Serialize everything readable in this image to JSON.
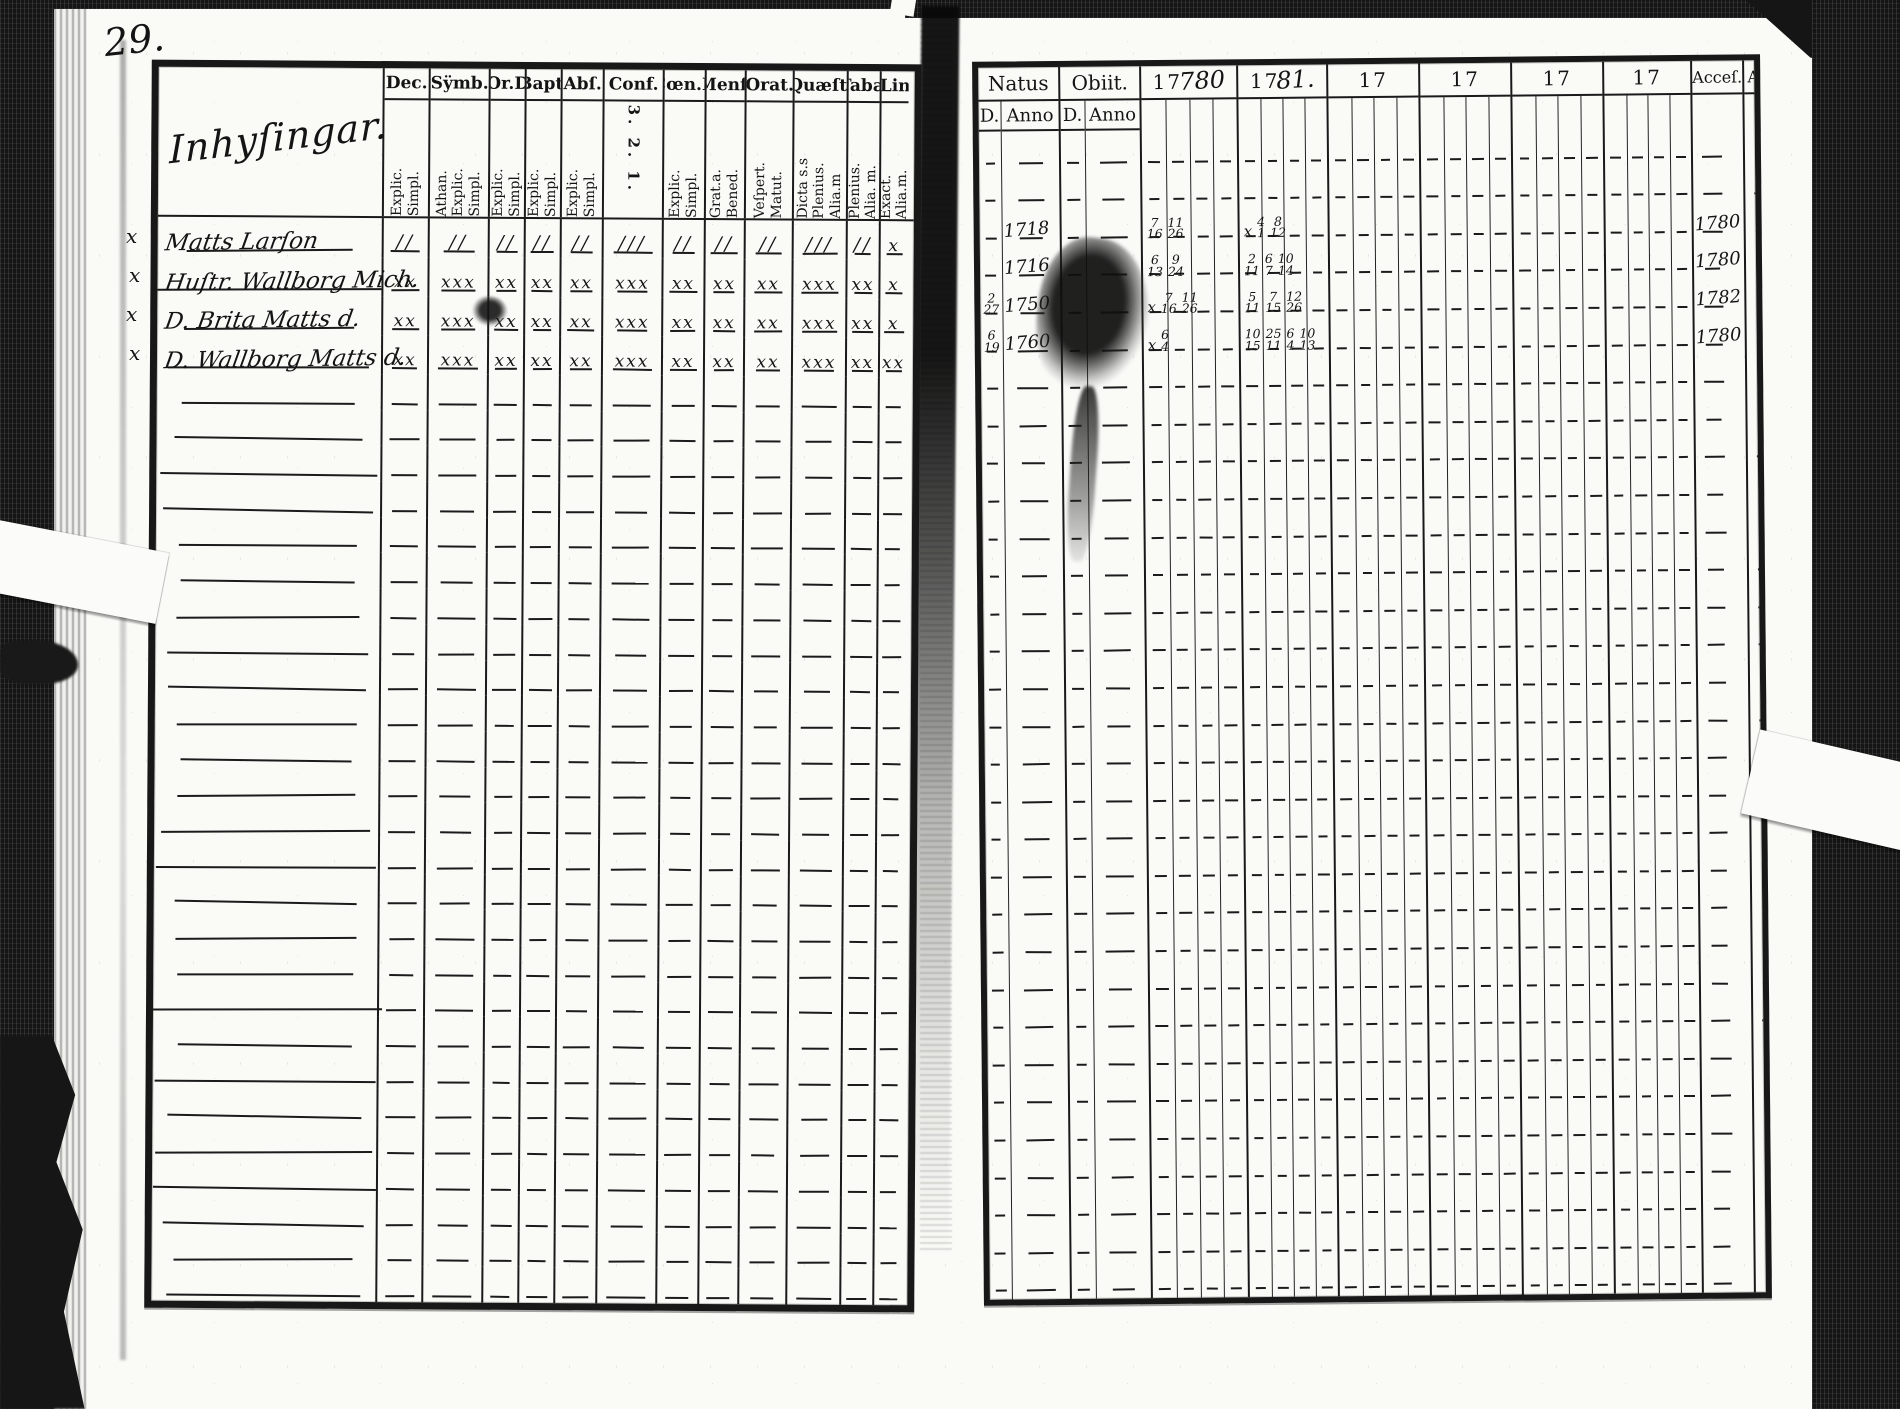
{
  "page_number": "29.",
  "left_page": {
    "title": "Inhyſingar.",
    "margin_marks": [
      "x",
      "x",
      "x",
      "x"
    ],
    "columns": [
      {
        "label": "Dec.",
        "sub": [
          "Explic.",
          "Simpl."
        ]
      },
      {
        "label": "Sÿmb.",
        "sub": [
          "Athan.",
          "Explic.",
          "Simpl."
        ]
      },
      {
        "label": "Or.D",
        "sub": [
          "Explic.",
          "Simpl."
        ]
      },
      {
        "label": "Bapt.",
        "sub": [
          "Explic.",
          "Simpl."
        ]
      },
      {
        "label": "Abſ.",
        "sub": [
          "Explic.",
          "Simpl."
        ]
      },
      {
        "label": "Conf.",
        "sub": [
          "3. 2. 1."
        ]
      },
      {
        "label": "Cœn.D",
        "sub": [
          "Explic.",
          "Simpl."
        ]
      },
      {
        "label": "Menſ.",
        "sub": [
          "Grat.a.",
          "Bened."
        ]
      },
      {
        "label": "Orat.",
        "sub": [
          "Veſpert.",
          "Matut."
        ]
      },
      {
        "label": "Quæſt.",
        "sub": [
          "Dicta s.s",
          "Plenius.",
          "Alia.m"
        ]
      },
      {
        "label": "Tabæ",
        "sub": [
          "Plenius.",
          "Alia. m."
        ]
      },
      {
        "label": "Lin",
        "sub": [
          "Exact.",
          "Alia.m."
        ]
      }
    ],
    "entries": [
      {
        "name": "Matts Larſon",
        "marks": [
          "//",
          "//",
          "//",
          "//",
          "//",
          "///",
          "//",
          "//",
          "//",
          "///",
          "//",
          "x"
        ]
      },
      {
        "name": "Huſtr. Wallborg Mich.",
        "marks": [
          "xx",
          "xxx",
          "xx",
          "xx",
          "xx",
          "xxx",
          "xx",
          "xx",
          "xx",
          "xxx",
          "xx",
          "x"
        ]
      },
      {
        "name": "D. Brita Matts d.",
        "marks": [
          "xx",
          "xxx",
          "xx",
          "xx",
          "xx",
          "xxx",
          "xx",
          "xx",
          "xx",
          "xxx",
          "xx",
          "x"
        ]
      },
      {
        "name": "D. Wallborg Matts d.",
        "marks": [
          "xx",
          "xxx",
          "xx",
          "xx",
          "xx",
          "xxx",
          "xx",
          "xx",
          "xx",
          "xxx",
          "xx",
          "xx"
        ]
      }
    ],
    "empty_row_count": 26
  },
  "right_page": {
    "natus_label": "Natus",
    "obiit_label": "Obiit.",
    "day_label": "D.",
    "anno_label": "Anno",
    "year_headers": [
      {
        "printed": "17",
        "script": "780"
      },
      {
        "printed": "17",
        "script": "81."
      },
      {
        "printed": "17",
        "script": ""
      },
      {
        "printed": "17",
        "script": ""
      },
      {
        "printed": "17",
        "script": ""
      },
      {
        "printed": "17",
        "script": ""
      }
    ],
    "accessit_label": "Acceſ.",
    "abiit_label": "Abit",
    "entries": [
      {
        "natus_d": "",
        "natus_anno": "1718",
        "y1": [
          "7/16",
          "11/26"
        ],
        "y2": [
          "x",
          "4/1",
          "8/12"
        ],
        "accessit": "1780"
      },
      {
        "natus_d": "",
        "natus_anno": "1716",
        "y1": [
          "6/13",
          "9/24"
        ],
        "y2": [
          "2/11",
          "6/7",
          "10/14"
        ],
        "accessit": "1780"
      },
      {
        "natus_d": "2/27",
        "natus_anno": "1750",
        "y1": [
          "x",
          "7/16",
          "11/26"
        ],
        "y2": [
          "5/11",
          "7/15",
          "12/26"
        ],
        "accessit": "1782"
      },
      {
        "natus_d": "6/19",
        "natus_anno": "1760",
        "y1": [
          "x",
          "6/4"
        ],
        "y2": [
          "10/15",
          "25/11",
          "6/4",
          "10/13"
        ],
        "accessit": "1780"
      }
    ],
    "empty_rows_before": 2,
    "empty_row_count": 25
  }
}
